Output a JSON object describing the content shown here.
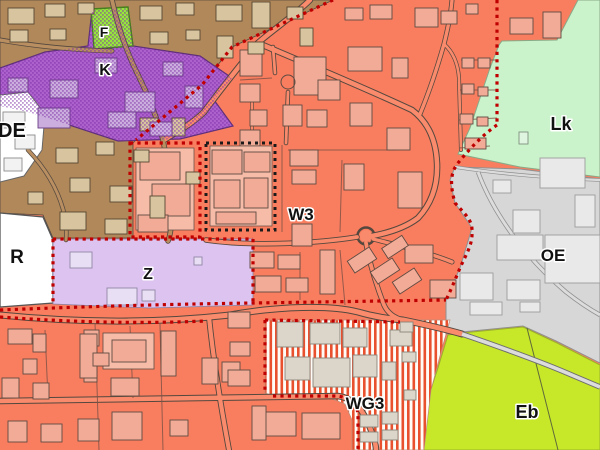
{
  "map": {
    "type": "zoning-land-use-map",
    "labels": {
      "f": "F",
      "k": "K",
      "de": "DE",
      "r": "R",
      "z": "Z",
      "w3": "W3",
      "oe": "OE",
      "lk": "Lk",
      "wg3": "WG3",
      "eb": "Eb"
    },
    "colors": {
      "orange_zone": "#F97E60",
      "orange_road": "#FA8A6C",
      "orange_building": "#F2AB97",
      "orange_building_pad": "#F6BCA8",
      "brown_zone": "#B1885A",
      "brown_road": "#B98F61",
      "brown_building": "#D8C5A0",
      "purple_zone": "#AC61CC",
      "purple_hatch": "#7E2FA6",
      "purple_building": "#CBAEDE",
      "bright_green_zone": "#97E63B",
      "pale_green_zone": "#CBF3CB",
      "pale_green_building": "#DFF5DF",
      "yellow_green_zone": "#C7E829",
      "gray_zone": "#D7D7D7",
      "gray_road": "#DCDCDC",
      "gray_building": "#E9E9E9",
      "lavender_zone": "#DCC3F0",
      "lavender_building": "#E9DFF4",
      "white_zone": "#FFFFFF",
      "white_building": "#F2F2F2",
      "stripe_red": "#E8502E",
      "stripe_bg": "#FFFBF7",
      "stripe_building": "#DBD5CA",
      "boundary_red": "#C00000",
      "boundary_black": "#1A1A1A",
      "road_casing": "#54483E"
    }
  }
}
